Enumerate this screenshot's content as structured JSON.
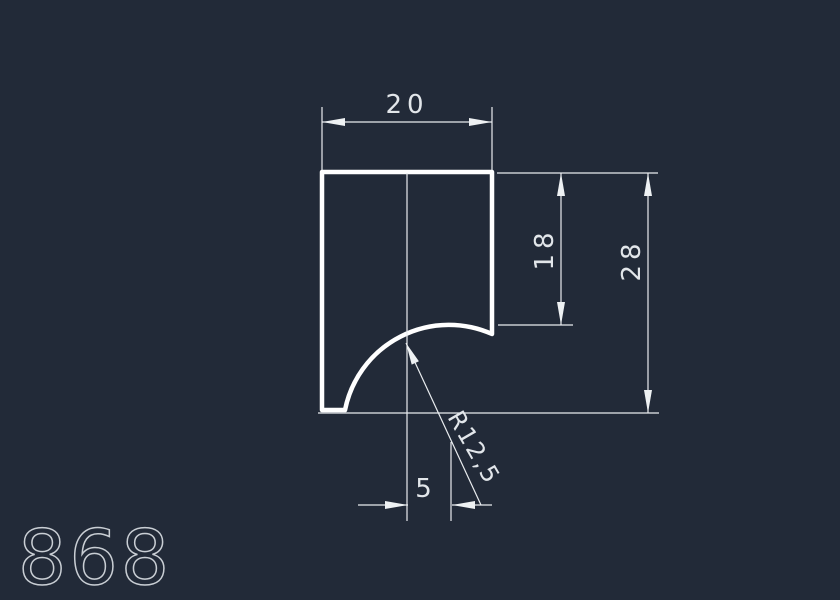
{
  "app": {
    "colors": {
      "background": "#222A38",
      "outline": "#ffffff",
      "dimension_lines": "#e9ecef",
      "dimension_text": "#e2e6ea",
      "part_number_text": "#c9ced4"
    }
  },
  "drawing": {
    "part_number": "868",
    "dims": {
      "width": "20",
      "side_depth": "18",
      "height": "28",
      "center_offset": "5",
      "radius": "R12,5"
    }
  }
}
